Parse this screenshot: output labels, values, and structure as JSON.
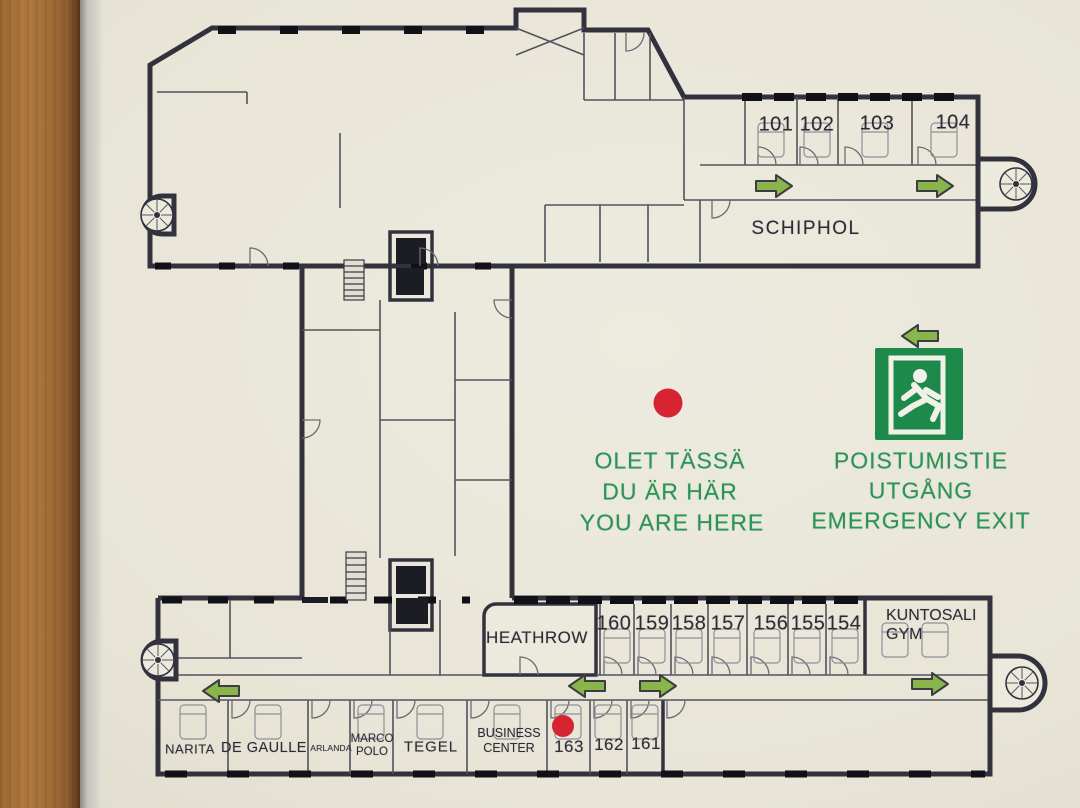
{
  "sign": {
    "type": "hotel emergency evacuation floor plan",
    "you_are_here": {
      "fi": "OLET TÄSSÄ",
      "sv": "DU ÄR HÄR",
      "en": "YOU ARE HERE"
    },
    "emergency_exit": {
      "fi": "POISTUMISTIE",
      "sv": "UTGÅNG",
      "en": "EMERGENCY EXIT"
    }
  },
  "rooms": {
    "top_numbers": [
      "101",
      "102",
      "103",
      "104"
    ],
    "schiphol": "SCHIPHOL",
    "heathrow": "HEATHROW",
    "bottom_numbers": [
      "160",
      "159",
      "158",
      "157",
      "156",
      "155",
      "154"
    ],
    "gym": "KUNTOSALI GYM",
    "narita": "NARITA",
    "de_gaulle": "DE GAULLE",
    "arlanda": "ARLANDA",
    "marco_polo": "MARCO POLO",
    "tegel": "TEGEL",
    "business_center": "BUSINESS CENTER",
    "lower_numbers": [
      "163",
      "162",
      "161"
    ]
  },
  "icons": {
    "exit_pictogram": "running-man-through-door",
    "direction_arrows": [
      "right",
      "right",
      "left",
      "left",
      "right",
      "right",
      "left"
    ],
    "stairwells": "spiral-staircase x4",
    "elevators": "elevator-shaft x4",
    "position_markers": "red-dot x2"
  },
  "colors": {
    "plan_ink": "#32323e",
    "sign_green": "#1d8a4c",
    "text_green": "#2a9355",
    "arrow_green": "#8ab54d",
    "marker_red": "#d62530",
    "paper": "#e9e6d9",
    "wood_frame": "#a8743c"
  }
}
